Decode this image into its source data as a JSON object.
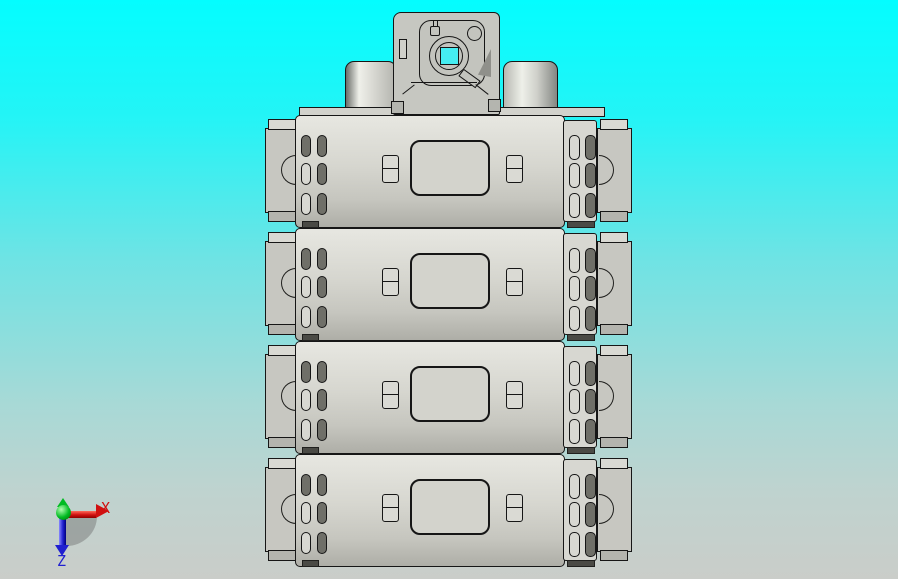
{
  "scene": {
    "kind": "cad-3d-viewport",
    "view_orientation": "front"
  },
  "triad": {
    "x_label": "X",
    "z_label": "Z"
  },
  "model": {
    "module_count": 4,
    "modules": [
      {
        "index": 1
      },
      {
        "index": 2
      },
      {
        "index": 3
      },
      {
        "index": 4
      }
    ],
    "terminal_slots_per_module_side": 6,
    "slot_grid": {
      "rows": 3,
      "cols": 2
    }
  },
  "colors": {
    "background_top": "#04fdff",
    "background_bottom": "#cacdc9",
    "edge": "#161616",
    "model_light": "#e7e7e1",
    "model_mid": "#c7c7c1",
    "slot_dark": "#6f6f68",
    "hole_cyan": "#45eef2",
    "axis_x": "#d01010",
    "axis_z": "#2020d0",
    "axis_origin": "#00bb22"
  }
}
